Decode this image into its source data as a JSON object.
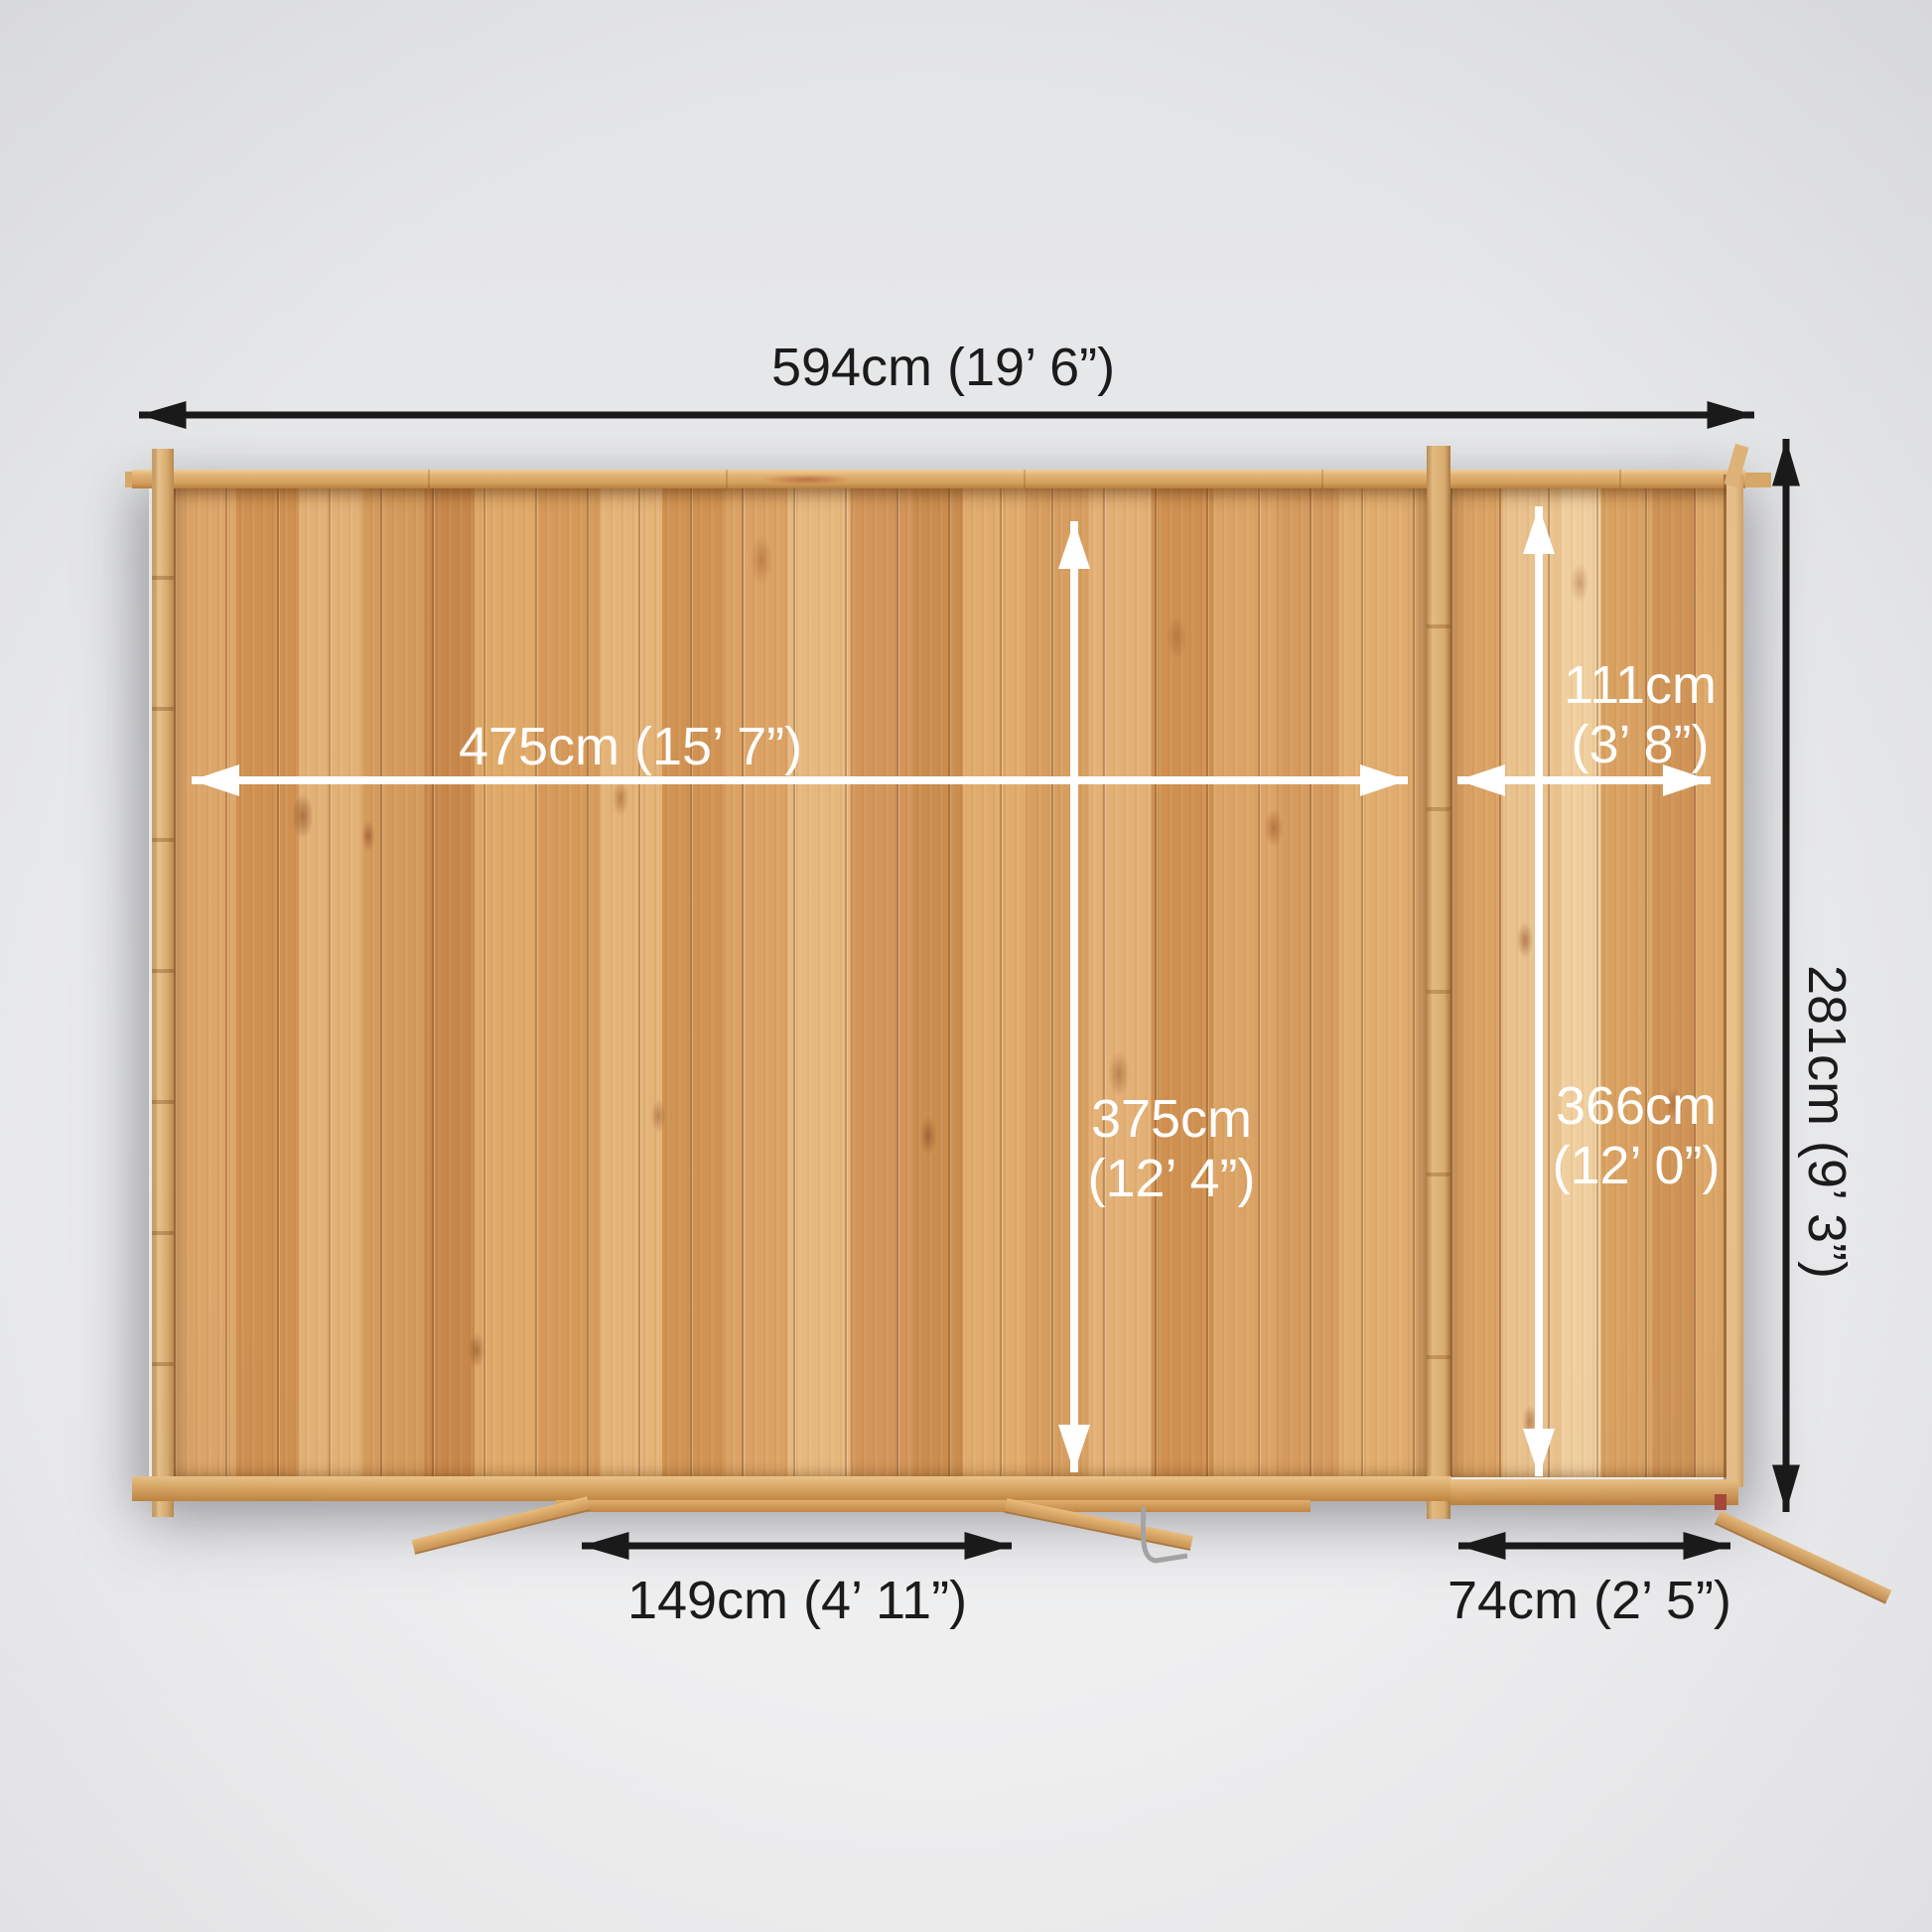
{
  "scene": {
    "description": "Top-down dimension plan of a log cabin with attached side store, open doors at the bottom",
    "background_top": "#e4e5e7",
    "background_bottom": "#f1f1f2"
  },
  "colors": {
    "arrow_black": "#1a1a1a",
    "arrow_white": "#ffffff",
    "wood_floor_base": "#d79e60",
    "wood_wall_light": "#e8c18a",
    "metal_gray": "#a3a3a3"
  },
  "dimensions": {
    "overall_width": "594cm (19’ 6”)",
    "overall_depth": "281cm (9’ 3”)",
    "main_internal_width": "475cm (15’ 7”)",
    "main_internal_depth_line1": "375cm",
    "main_internal_depth_line2": "(12’ 4”)",
    "side_internal_width_line1": "111cm",
    "side_internal_width_line2": "(3’ 8”)",
    "side_internal_depth_line1": "366cm",
    "side_internal_depth_line2": "(12’ 0”)",
    "main_door_width": "149cm (4’ 11”)",
    "side_door_width": "74cm (2’ 5”)"
  }
}
